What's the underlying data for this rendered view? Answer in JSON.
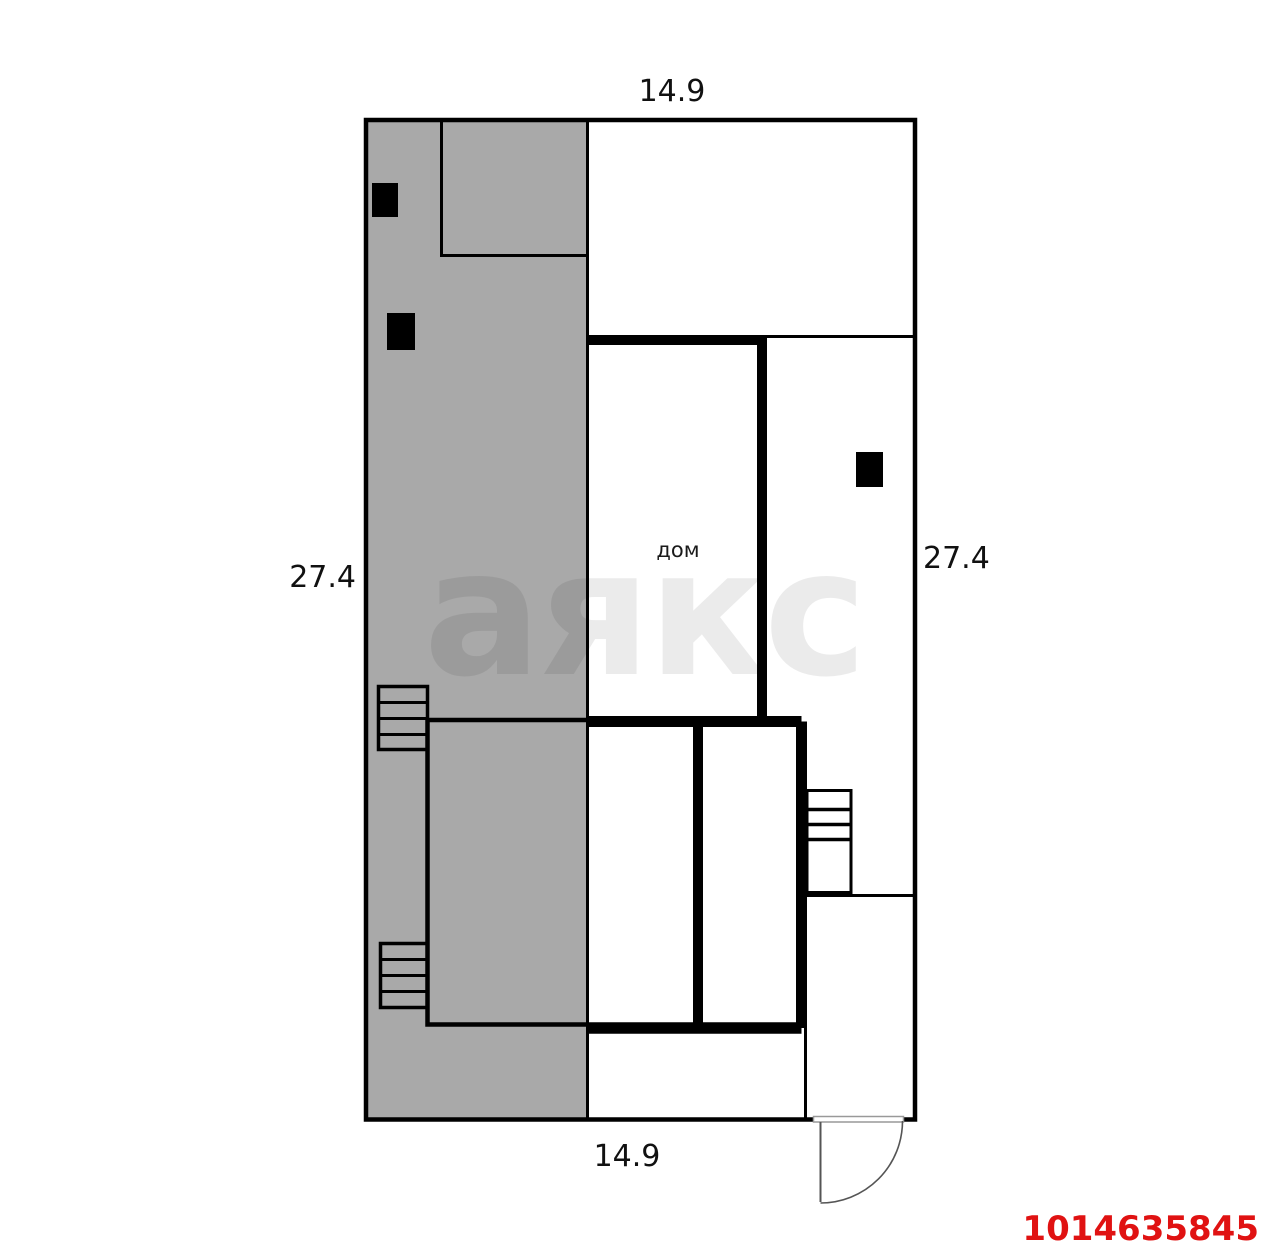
{
  "floorplan": {
    "labels": {
      "width_top": "14.9",
      "width_bottom": "14.9",
      "height_left": "27.4",
      "height_right": "27.4",
      "house": "дом"
    },
    "watermark_text": "аякс",
    "listing_id": "1014635845",
    "colors": {
      "walls": "#000000",
      "yard_fill": "#a9a9a9",
      "watermark_fill": "rgba(0,0,0,0.08)",
      "listing_id_color": "#e01212",
      "door_stroke": "#555555",
      "threshold_stroke": "#999999",
      "background": "#ffffff"
    }
  }
}
